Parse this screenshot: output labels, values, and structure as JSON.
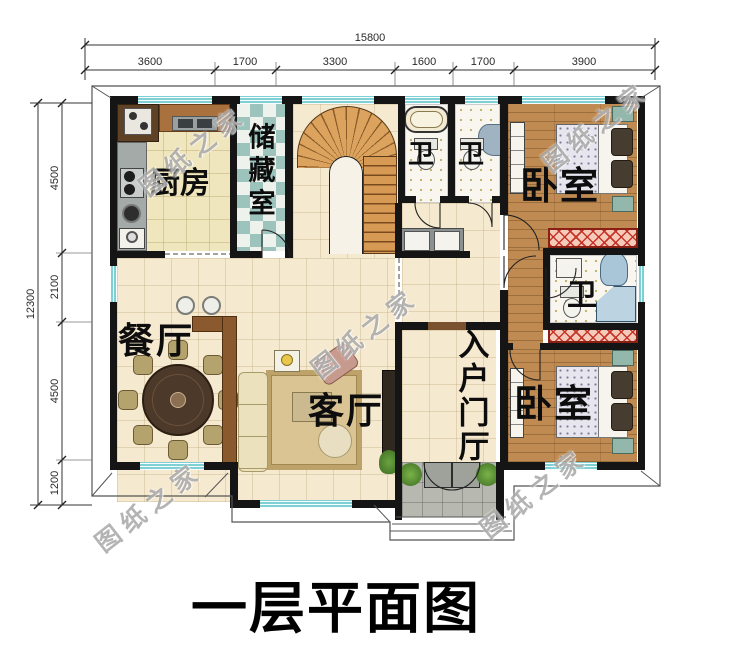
{
  "title": "一层平面图",
  "watermark": "图纸之家",
  "dimensions": {
    "top_total": "15800",
    "top_segments": [
      "3600",
      "1700",
      "3300",
      "1600",
      "1700",
      "3900"
    ],
    "left_total": "12300",
    "left_segments": [
      "4500",
      "2100",
      "4500",
      "1200"
    ]
  },
  "rooms": {
    "kitchen": "厨房",
    "storage": "储藏室",
    "bath1": "卫",
    "bath2": "卫",
    "bath3": "卫",
    "bedroom_top": "卧室",
    "bedroom_bottom": "卧室",
    "dining": "餐厅",
    "living": "客厅",
    "entry_hall": "入户门厅"
  },
  "colors": {
    "wall": "#151515",
    "window": "#7fd0d4",
    "floor_tile": "#f5e9cf",
    "floor_kitchen": "#f0e6bd",
    "floor_wood": "#c08b52",
    "floor_bath": "#f8f6ee",
    "storage_teal": "#9cc3bc",
    "porch_gray": "#b7b9b0",
    "hatch_red": "#c0392b",
    "stair_wood": "#d79a55"
  }
}
